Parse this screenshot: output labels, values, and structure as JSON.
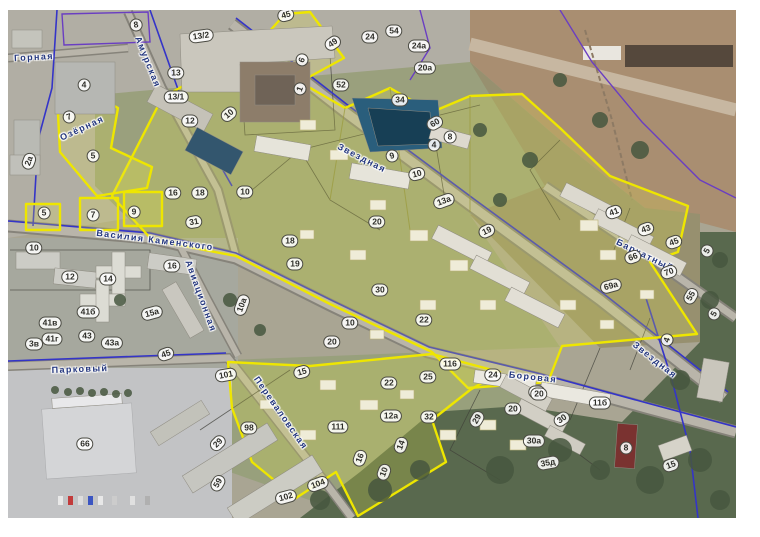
{
  "map": {
    "colors": {
      "zone_outline": "#eee600",
      "zone_fill": "rgba(232,230,70,0.22)",
      "utility_blue": "#3434c8",
      "utility_purple": "#6a3ec2",
      "street_text": "#23367e",
      "badge_bg": "rgba(255,255,255,0.88)",
      "badge_border": "#4a4a42"
    },
    "streets": [
      {
        "name": "Горная",
        "x": 34,
        "y": 57,
        "angle": -3
      },
      {
        "name": "Амурская",
        "x": 148,
        "y": 62,
        "angle": 68
      },
      {
        "name": "Озёрная",
        "x": 82,
        "y": 128,
        "angle": -25
      },
      {
        "name": "Василия Каменского",
        "x": 155,
        "y": 240,
        "angle": 7
      },
      {
        "name": "Авиационная",
        "x": 201,
        "y": 296,
        "angle": 70
      },
      {
        "name": "Звездная",
        "x": 362,
        "y": 158,
        "angle": 27
      },
      {
        "name": "Звездная",
        "x": 655,
        "y": 360,
        "angle": 38
      },
      {
        "name": "Бархатный",
        "x": 645,
        "y": 255,
        "angle": 26
      },
      {
        "name": "Боровая",
        "x": 533,
        "y": 377,
        "angle": 6
      },
      {
        "name": "Парковый",
        "x": 80,
        "y": 369,
        "angle": -2
      },
      {
        "name": "Переваловская",
        "x": 281,
        "y": 413,
        "angle": 55
      }
    ],
    "parcels": [
      {
        "n": "8",
        "x": 136,
        "y": 25,
        "r": -8
      },
      {
        "n": "13/2",
        "x": 201,
        "y": 36,
        "r": -8
      },
      {
        "n": "13",
        "x": 176,
        "y": 73,
        "r": 0
      },
      {
        "n": "13/1",
        "x": 176,
        "y": 97,
        "r": 0
      },
      {
        "n": "4",
        "x": 84,
        "y": 85,
        "r": 0
      },
      {
        "n": "10",
        "x": 229,
        "y": 114,
        "r": -40
      },
      {
        "n": "12",
        "x": 190,
        "y": 121,
        "r": 0
      },
      {
        "n": "7",
        "x": 69,
        "y": 117,
        "r": -20
      },
      {
        "n": "5",
        "x": 93,
        "y": 156,
        "r": 0
      },
      {
        "n": "2а",
        "x": 29,
        "y": 161,
        "r": -70
      },
      {
        "n": "45",
        "x": 286,
        "y": 15,
        "r": -15
      },
      {
        "n": "49",
        "x": 333,
        "y": 43,
        "r": -35
      },
      {
        "n": "24",
        "x": 370,
        "y": 37,
        "r": 0
      },
      {
        "n": "54",
        "x": 394,
        "y": 31,
        "r": 0
      },
      {
        "n": "24а",
        "x": 419,
        "y": 46,
        "r": 0
      },
      {
        "n": "20а",
        "x": 425,
        "y": 68,
        "r": 0
      },
      {
        "n": "6",
        "x": 302,
        "y": 60,
        "r": -70
      },
      {
        "n": "52",
        "x": 341,
        "y": 85,
        "r": 0
      },
      {
        "n": "1",
        "x": 300,
        "y": 89,
        "r": -70
      },
      {
        "n": "34",
        "x": 400,
        "y": 100,
        "r": 0
      },
      {
        "n": "60",
        "x": 435,
        "y": 123,
        "r": -30
      },
      {
        "n": "8",
        "x": 450,
        "y": 137,
        "r": 0
      },
      {
        "n": "4",
        "x": 434,
        "y": 145,
        "r": 0
      },
      {
        "n": "9",
        "x": 392,
        "y": 156,
        "r": -15
      },
      {
        "n": "10",
        "x": 417,
        "y": 174,
        "r": -15
      },
      {
        "n": "16",
        "x": 173,
        "y": 193,
        "r": 0
      },
      {
        "n": "18",
        "x": 200,
        "y": 193,
        "r": 0
      },
      {
        "n": "10",
        "x": 245,
        "y": 192,
        "r": 0
      },
      {
        "n": "31",
        "x": 194,
        "y": 222,
        "r": -10
      },
      {
        "n": "5",
        "x": 44,
        "y": 213,
        "r": 0
      },
      {
        "n": "7",
        "x": 93,
        "y": 215,
        "r": 0
      },
      {
        "n": "9",
        "x": 134,
        "y": 212,
        "r": 0
      },
      {
        "n": "10",
        "x": 34,
        "y": 248,
        "r": 0
      },
      {
        "n": "12",
        "x": 70,
        "y": 277,
        "r": 0
      },
      {
        "n": "14",
        "x": 108,
        "y": 279,
        "r": 0
      },
      {
        "n": "16",
        "x": 172,
        "y": 266,
        "r": 0
      },
      {
        "n": "10а",
        "x": 242,
        "y": 305,
        "r": -70
      },
      {
        "n": "41б",
        "x": 88,
        "y": 312,
        "r": 0
      },
      {
        "n": "3в",
        "x": 34,
        "y": 344,
        "r": 0
      },
      {
        "n": "41в",
        "x": 50,
        "y": 323,
        "r": 0
      },
      {
        "n": "41г",
        "x": 52,
        "y": 339,
        "r": 0
      },
      {
        "n": "43",
        "x": 87,
        "y": 336,
        "r": 0
      },
      {
        "n": "43а",
        "x": 112,
        "y": 343,
        "r": 0
      },
      {
        "n": "15а",
        "x": 152,
        "y": 313,
        "r": -15
      },
      {
        "n": "45",
        "x": 166,
        "y": 354,
        "r": -20
      },
      {
        "n": "18",
        "x": 290,
        "y": 241,
        "r": 0
      },
      {
        "n": "19",
        "x": 295,
        "y": 264,
        "r": 0
      },
      {
        "n": "20",
        "x": 377,
        "y": 222,
        "r": 0
      },
      {
        "n": "30",
        "x": 380,
        "y": 290,
        "r": 0
      },
      {
        "n": "10",
        "x": 350,
        "y": 323,
        "r": 0
      },
      {
        "n": "20",
        "x": 332,
        "y": 342,
        "r": 0
      },
      {
        "n": "13а",
        "x": 444,
        "y": 201,
        "r": -20
      },
      {
        "n": "19",
        "x": 487,
        "y": 231,
        "r": -25
      },
      {
        "n": "22",
        "x": 424,
        "y": 320,
        "r": 0
      },
      {
        "n": "41",
        "x": 614,
        "y": 212,
        "r": -20
      },
      {
        "n": "43",
        "x": 646,
        "y": 229,
        "r": -20
      },
      {
        "n": "45",
        "x": 674,
        "y": 242,
        "r": -20
      },
      {
        "n": "66",
        "x": 633,
        "y": 257,
        "r": -20
      },
      {
        "n": "70",
        "x": 669,
        "y": 272,
        "r": -20
      },
      {
        "n": "69а",
        "x": 611,
        "y": 286,
        "r": -15
      },
      {
        "n": "5",
        "x": 707,
        "y": 251,
        "r": -60
      },
      {
        "n": "55",
        "x": 691,
        "y": 296,
        "r": -60
      },
      {
        "n": "4",
        "x": 667,
        "y": 340,
        "r": -70
      },
      {
        "n": "5",
        "x": 714,
        "y": 314,
        "r": -60
      },
      {
        "n": "15",
        "x": 302,
        "y": 372,
        "r": -15
      },
      {
        "n": "22",
        "x": 389,
        "y": 383,
        "r": 0
      },
      {
        "n": "25",
        "x": 428,
        "y": 377,
        "r": 0
      },
      {
        "n": "116",
        "x": 450,
        "y": 364,
        "r": 0
      },
      {
        "n": "24",
        "x": 493,
        "y": 375,
        "r": 0
      },
      {
        "n": "28",
        "x": 537,
        "y": 392,
        "r": 0
      },
      {
        "n": "12а",
        "x": 391,
        "y": 416,
        "r": 0
      },
      {
        "n": "32",
        "x": 429,
        "y": 417,
        "r": 0
      },
      {
        "n": "29",
        "x": 477,
        "y": 419,
        "r": -60
      },
      {
        "n": "14",
        "x": 401,
        "y": 445,
        "r": -70
      },
      {
        "n": "16",
        "x": 360,
        "y": 458,
        "r": -70
      },
      {
        "n": "10",
        "x": 384,
        "y": 472,
        "r": -70
      },
      {
        "n": "111",
        "x": 338,
        "y": 427,
        "r": 0
      },
      {
        "n": "104",
        "x": 318,
        "y": 484,
        "r": -20
      },
      {
        "n": "102",
        "x": 286,
        "y": 497,
        "r": -15
      },
      {
        "n": "101",
        "x": 226,
        "y": 375,
        "r": -10
      },
      {
        "n": "98",
        "x": 249,
        "y": 428,
        "r": 0
      },
      {
        "n": "29",
        "x": 218,
        "y": 443,
        "r": -45
      },
      {
        "n": "59",
        "x": 218,
        "y": 483,
        "r": -60
      },
      {
        "n": "66",
        "x": 85,
        "y": 444,
        "r": 0
      },
      {
        "n": "20",
        "x": 539,
        "y": 394,
        "r": 0
      },
      {
        "n": "20",
        "x": 513,
        "y": 409,
        "r": 0
      },
      {
        "n": "30",
        "x": 562,
        "y": 419,
        "r": -35
      },
      {
        "n": "30а",
        "x": 534,
        "y": 441,
        "r": 0
      },
      {
        "n": "11б",
        "x": 600,
        "y": 403,
        "r": 0
      },
      {
        "n": "35д",
        "x": 548,
        "y": 463,
        "r": -10
      },
      {
        "n": "8",
        "x": 626,
        "y": 448,
        "r": 0
      },
      {
        "n": "15",
        "x": 671,
        "y": 465,
        "r": -20
      }
    ]
  }
}
